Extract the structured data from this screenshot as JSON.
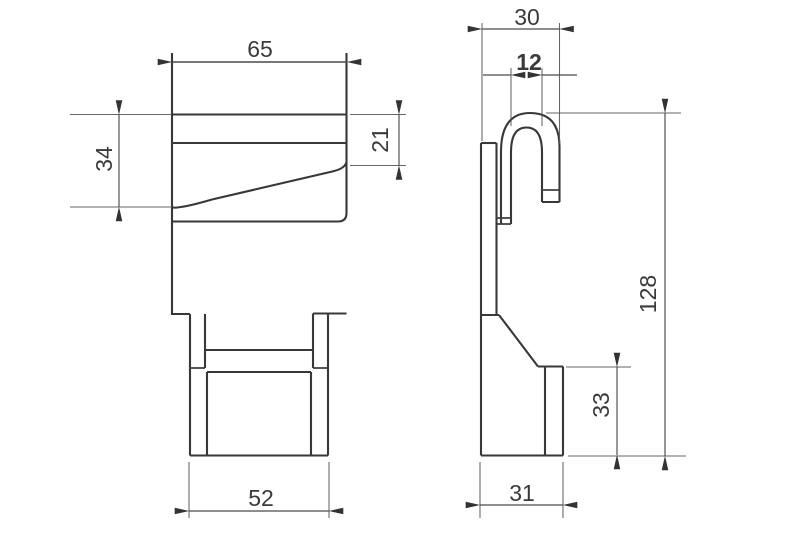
{
  "drawing": {
    "background": "#ffffff",
    "line_color": "#383838",
    "front_view": {
      "dim_top_width": "65",
      "dim_hook_height": "34",
      "dim_lip_height": "21",
      "dim_bottom_width": "52"
    },
    "side_view": {
      "dim_top_depth": "30",
      "dim_slot_width": "12",
      "dim_overall_height": "128",
      "dim_base_height": "33",
      "dim_bottom_depth": "31"
    }
  }
}
